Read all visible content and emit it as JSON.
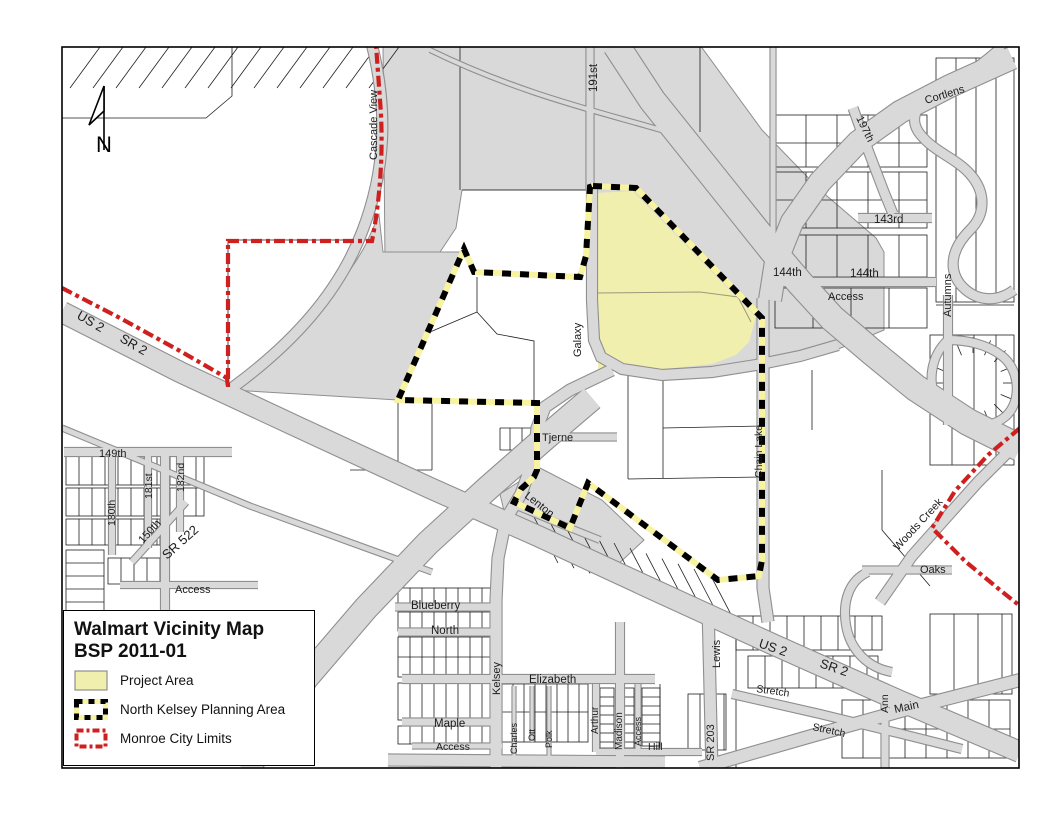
{
  "title": {
    "line1": "Walmart Vicinity Map",
    "line2": "BSP 2011-01"
  },
  "legend": {
    "items": [
      {
        "key": "project-area",
        "label": "Project Area",
        "swatch": "project"
      },
      {
        "key": "north-kelsey-planning-area",
        "label": "North Kelsey Planning Area",
        "swatch": "planning"
      },
      {
        "key": "monroe-city-limits",
        "label": "Monroe City Limits",
        "swatch": "city_limits"
      }
    ]
  },
  "north_arrow": {
    "label": "N"
  },
  "colors": {
    "background": "#ffffff",
    "frame": "#000000",
    "gray_area": "#d9d9d9",
    "road_fill": "#d9d9d9",
    "road_edge": "#8f8f8f",
    "parcel_line": "#1f1f1f",
    "project_fill": "#f1efae",
    "planning_backing": "#f7f3a0",
    "planning_dash": "#000000",
    "city_limits": "#cf2020",
    "label_text": "#1c1c1c"
  },
  "map": {
    "street_labels": [
      {
        "text": "Cascade View",
        "x": 377,
        "y": 160,
        "rot": -90,
        "size": 11
      },
      {
        "text": "191st",
        "x": 597,
        "y": 92,
        "rot": -90,
        "size": 11.5
      },
      {
        "text": "Cortlens",
        "x": 926,
        "y": 104,
        "rot": -17,
        "size": 11
      },
      {
        "text": "197th",
        "x": 856,
        "y": 118,
        "rot": 64,
        "size": 11
      },
      {
        "text": "143rd",
        "x": 874,
        "y": 223,
        "rot": 0,
        "size": 11.5
      },
      {
        "text": "144th",
        "x": 773,
        "y": 276,
        "rot": 0,
        "size": 11.5
      },
      {
        "text": "144th",
        "x": 850,
        "y": 277,
        "rot": 0,
        "size": 11.5
      },
      {
        "text": "Access",
        "x": 828,
        "y": 300,
        "rot": 0,
        "size": 11
      },
      {
        "text": "Autumns",
        "x": 951,
        "y": 317,
        "rot": -90,
        "size": 11
      },
      {
        "text": "US 2",
        "x": 76,
        "y": 318,
        "rot": 30,
        "size": 13
      },
      {
        "text": "SR 2",
        "x": 119,
        "y": 341,
        "rot": 30,
        "size": 13
      },
      {
        "text": "Galaxy",
        "x": 581,
        "y": 357,
        "rot": -90,
        "size": 11
      },
      {
        "text": "Chain Lake",
        "x": 762,
        "y": 478,
        "rot": -90,
        "size": 10.5
      },
      {
        "text": "Tjerne",
        "x": 542,
        "y": 441,
        "rot": 0,
        "size": 11
      },
      {
        "text": "149th",
        "x": 99,
        "y": 457,
        "rot": 0,
        "size": 11
      },
      {
        "text": "181st",
        "x": 152,
        "y": 499,
        "rot": -90,
        "size": 10.5
      },
      {
        "text": "182nd",
        "x": 184,
        "y": 492,
        "rot": -90,
        "size": 10.5
      },
      {
        "text": "180th",
        "x": 115,
        "y": 526,
        "rot": -90,
        "size": 10.5
      },
      {
        "text": "150th",
        "x": 143,
        "y": 544,
        "rot": -48,
        "size": 11
      },
      {
        "text": "SR 522",
        "x": 167,
        "y": 560,
        "rot": -42,
        "size": 13
      },
      {
        "text": "Lenton",
        "x": 524,
        "y": 497,
        "rot": 38,
        "size": 11
      },
      {
        "text": "Woods Creek",
        "x": 898,
        "y": 551,
        "rot": -47,
        "size": 11
      },
      {
        "text": "Access",
        "x": 175,
        "y": 593,
        "rot": 0,
        "size": 11
      },
      {
        "text": "Oaks",
        "x": 920,
        "y": 573,
        "rot": 0,
        "size": 11
      },
      {
        "text": "Blueberry",
        "x": 411,
        "y": 609,
        "rot": 0,
        "size": 11.5
      },
      {
        "text": "North",
        "x": 431,
        "y": 634,
        "rot": 0,
        "size": 11.5
      },
      {
        "text": "US 2",
        "x": 758,
        "y": 647,
        "rot": 19,
        "size": 13
      },
      {
        "text": "SR 2",
        "x": 819,
        "y": 667,
        "rot": 19,
        "size": 13
      },
      {
        "text": "Kelsey",
        "x": 500,
        "y": 695,
        "rot": -90,
        "size": 11
      },
      {
        "text": "Lewis",
        "x": 720,
        "y": 668,
        "rot": -90,
        "size": 11
      },
      {
        "text": "Elizabeth",
        "x": 529,
        "y": 683,
        "rot": 0,
        "size": 11.5
      },
      {
        "text": "Stretch",
        "x": 756,
        "y": 692,
        "rot": 8,
        "size": 10.5
      },
      {
        "text": "Stretch",
        "x": 812,
        "y": 730,
        "rot": 12,
        "size": 10.5
      },
      {
        "text": "Ann",
        "x": 888,
        "y": 713,
        "rot": -90,
        "size": 10.5
      },
      {
        "text": "Main",
        "x": 895,
        "y": 713,
        "rot": -12,
        "size": 11.5
      },
      {
        "text": "Maple",
        "x": 434,
        "y": 727,
        "rot": 0,
        "size": 11.5
      },
      {
        "text": "Charles",
        "x": 517,
        "y": 754,
        "rot": -90,
        "size": 9
      },
      {
        "text": "Ott",
        "x": 535,
        "y": 741,
        "rot": -90,
        "size": 9
      },
      {
        "text": "Polk",
        "x": 552,
        "y": 748,
        "rot": -90,
        "size": 9
      },
      {
        "text": "Arthur",
        "x": 598,
        "y": 734,
        "rot": -90,
        "size": 10
      },
      {
        "text": "Madison",
        "x": 622,
        "y": 750,
        "rot": -90,
        "size": 10
      },
      {
        "text": "Access",
        "x": 641,
        "y": 746,
        "rot": -90,
        "size": 9
      },
      {
        "text": "Hill",
        "x": 648,
        "y": 750,
        "rot": 0,
        "size": 10.5
      },
      {
        "text": "SR 203",
        "x": 714,
        "y": 761,
        "rot": -90,
        "size": 11
      },
      {
        "text": "Access",
        "x": 436,
        "y": 750,
        "rot": 0,
        "size": 10.5
      }
    ]
  }
}
